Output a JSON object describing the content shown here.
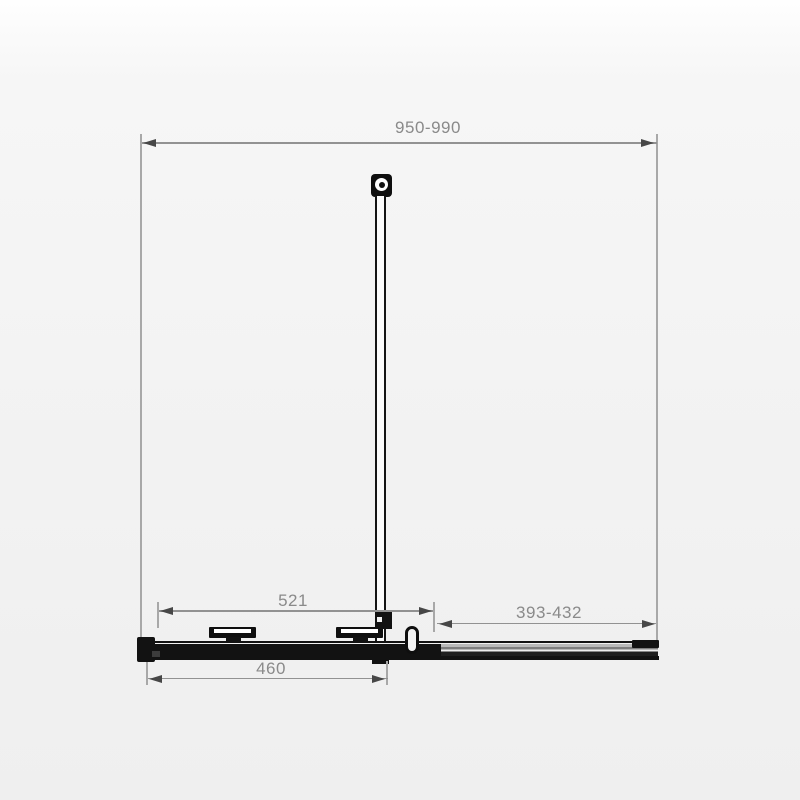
{
  "diagram": {
    "type": "technical-dimension-drawing",
    "labels": {
      "overall_width_top": "950-990",
      "inner_left": "521",
      "inner_right": "393-432",
      "bottom_width": "460"
    },
    "colors": {
      "dimension_line": "#929292",
      "dimension_text": "#8a8a8a",
      "arrowhead": "#474747",
      "profile_ink": "#121212",
      "background": "#f3f3f3"
    }
  }
}
